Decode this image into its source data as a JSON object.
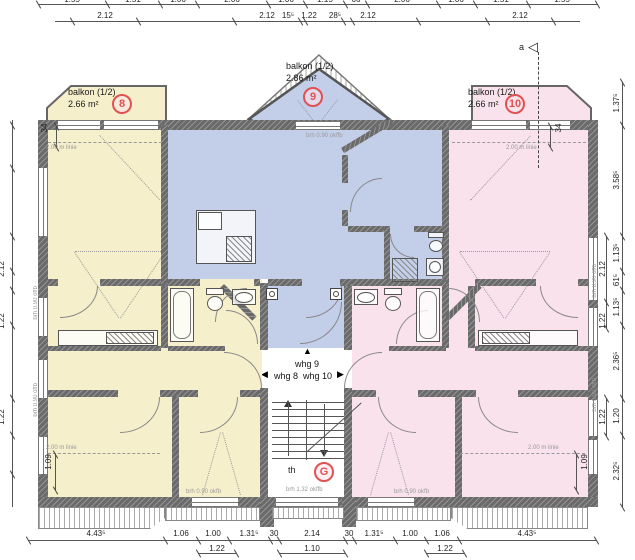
{
  "colors": {
    "unit8": "#f6efcb",
    "unit9": "#c3cee9",
    "unit10": "#f9e2ec",
    "circle": "#e05252"
  },
  "rooms": {
    "balkon8": {
      "name": "balkon (1/2)",
      "area": "2.66 m²",
      "unit": "8"
    },
    "balkon9": {
      "name": "balkon (1/2)",
      "area": "2.86 m²",
      "unit": "9"
    },
    "balkon10": {
      "name": "balkon (1/2)",
      "area": "2.66 m²",
      "unit": "10"
    },
    "wohnen8": {
      "name": "wohnen/essen",
      "area": "27.77 m²",
      "unit": "8"
    },
    "wohnen10": {
      "name": "wohnen/essen",
      "area": "27.77 m²",
      "unit": "10"
    },
    "kochen9": {
      "name": "kochen/essen/wohnen",
      "area": "34.07 m²",
      "unit": "9"
    },
    "schlafen9": {
      "name": "schlafen",
      "area": "12.42 m²",
      "unit": "9"
    },
    "bad9": {
      "name": "bad",
      "area": "3.94 m²",
      "unit": "9"
    },
    "flur9": {
      "name": "flur",
      "area": "4.67 m²",
      "unit": "9"
    },
    "kueche8": {
      "name": "küche",
      "area": "5.13 m²",
      "unit": "8"
    },
    "bad8": {
      "name": "bad",
      "area": "5.36 m²",
      "unit": "8"
    },
    "flur8": {
      "name": "flur",
      "area": "5.00 m²",
      "unit": "8"
    },
    "schlafen8a": {
      "name": "schlafen",
      "area": "16.45 m²",
      "unit": "8"
    },
    "schlafen8b": {
      "name": "schlafen",
      "area": "10.90 m²",
      "unit": "8"
    },
    "kueche10": {
      "name": "küche",
      "area": "5.13 m²",
      "unit": "10"
    },
    "bad10": {
      "name": "bad",
      "area": "5.36 m²",
      "unit": "10"
    },
    "flur10": {
      "name": "flur",
      "area": "5.00 m²",
      "unit": "10"
    },
    "schlafen10a": {
      "name": "schlafen",
      "area": "16.45 m²",
      "unit": "10"
    },
    "schlafen10b": {
      "name": "schlafen",
      "area": "10.90 m²",
      "unit": "10"
    }
  },
  "stair": {
    "label": "th",
    "unit": "G",
    "window_note": "brh 1.32 okffb"
  },
  "levels": {
    "okffb": "okffb + 5.34",
    "okrfb": "okrfb + 5.25"
  },
  "nav": {
    "whg8": "whg 8",
    "whg9": "whg 9",
    "whg10": "whg 10"
  },
  "icons": {
    "arrow_up": "▲",
    "arrow_left": "◀",
    "arrow_right": "▶",
    "section_marker": "◁"
  },
  "annotations": {
    "linie_200": "2.00 m linie",
    "brh_090_offb": "brh 0.90 offb",
    "brh_090_okffb": "brh 0.90 okffb",
    "brh_090_okfb": "brh 0.90 okfb",
    "section": "a"
  },
  "dims": {
    "top_row1": [
      "1.55",
      "1.51",
      "1.06",
      "2.06",
      "1.06",
      "1.15",
      "66",
      "2.06",
      "1.06",
      "1.51",
      "1.55"
    ],
    "top_row2": [
      "2.12",
      "2.12",
      "15⁵",
      "1.22",
      "28⁵",
      "2.12",
      "2.12"
    ],
    "bottom_row1": [
      "4.43⁵",
      "1.06",
      "1.00",
      "1.31⁵",
      "30",
      "2.14",
      "30",
      "1.31⁵",
      "1.00",
      "1.06",
      "4.43⁵"
    ],
    "bottom_row2": [
      "1.22",
      "1.10",
      "1.22"
    ],
    "right_outer": [
      "1.37⁵",
      "3.58⁵",
      "1.13⁵",
      "61⁵",
      "1.13⁵",
      "2.36⁵",
      "1.20",
      "2.32⁵"
    ],
    "right_inner": [
      "2.12",
      "1.22",
      "1.22"
    ],
    "left_inner": [
      "2.12",
      "1.22",
      "1.22"
    ],
    "wall_offset": "34",
    "v109": "1.09"
  }
}
